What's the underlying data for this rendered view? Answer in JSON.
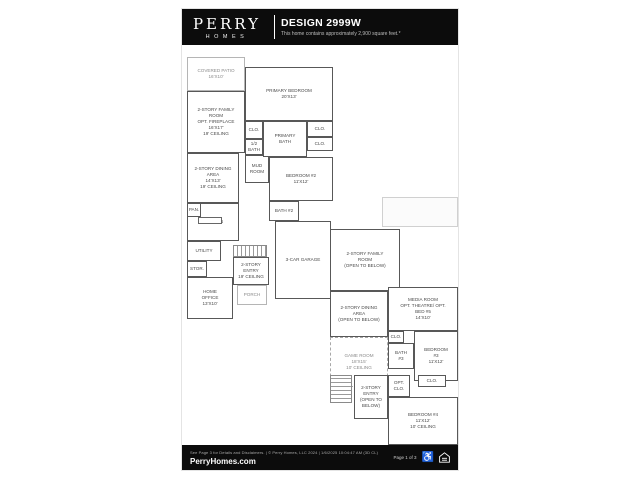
{
  "header": {
    "brand": {
      "name": "PERRY",
      "sub": "HOMES"
    },
    "title": "DESIGN 2999W",
    "subtitle": "This home contains approximately 2,900 square feet.*"
  },
  "footer": {
    "disclaimer": "See Page 3 for Details and Disclaimers.  |  © Perry Homes, LLC 2024  |  1/6/2025 10:04:47 AM  (3D CL)",
    "website": "PerryHomes.com",
    "page_info": "Page 1 of 3",
    "icons": [
      "accessibility-icon",
      "equal-housing-icon"
    ]
  },
  "floorplan": {
    "first_floor": {
      "rooms": [
        {
          "id": "covered-patio",
          "label": "COVERED PATIO\n16'x10'",
          "style": "open",
          "box": [
            5,
            12,
            58,
            34
          ]
        },
        {
          "id": "family-room",
          "label": "2-STORY FAMILY\nROOM\nOPT. FIREPLACE\n16'x17'\n19' Ceiling",
          "style": "solid",
          "box": [
            5,
            46,
            58,
            62
          ]
        },
        {
          "id": "dining-area",
          "label": "2-STORY DINING\nAREA\n14'x13'\n19' Ceiling",
          "style": "solid",
          "box": [
            5,
            108,
            52,
            50
          ]
        },
        {
          "id": "kitchen",
          "label": "KITCHEN",
          "style": "solid",
          "box": [
            5,
            158,
            52,
            38
          ]
        },
        {
          "id": "pantry",
          "label": "PAN.",
          "style": "solid",
          "box": [
            5,
            158,
            14,
            14
          ]
        },
        {
          "id": "utility",
          "label": "UTILITY",
          "style": "solid",
          "box": [
            5,
            196,
            34,
            20
          ]
        },
        {
          "id": "storage-1",
          "label": "STOR.",
          "style": "solid",
          "box": [
            5,
            216,
            20,
            16
          ]
        },
        {
          "id": "home-office",
          "label": "HOME\nOFFICE\n13'x10'",
          "style": "solid",
          "box": [
            5,
            232,
            46,
            42
          ]
        },
        {
          "id": "entry-1",
          "label": "2-STORY\nENTRY\n19' Ceiling",
          "style": "solid",
          "box": [
            51,
            212,
            36,
            28
          ]
        },
        {
          "id": "porch",
          "label": "PORCH",
          "style": "open",
          "box": [
            55,
            240,
            30,
            20
          ]
        },
        {
          "id": "primary-bedroom",
          "label": "PRIMARY BEDROOM\n20'x13'",
          "style": "solid",
          "box": [
            63,
            22,
            88,
            54
          ]
        },
        {
          "id": "closet-1",
          "label": "CLO.",
          "style": "solid",
          "box": [
            63,
            76,
            18,
            18
          ]
        },
        {
          "id": "half-bath",
          "label": "1/2\nBATH",
          "style": "solid",
          "box": [
            63,
            94,
            18,
            16
          ]
        },
        {
          "id": "mud-room",
          "label": "MUD\nROOM",
          "style": "solid",
          "box": [
            63,
            110,
            24,
            28
          ]
        },
        {
          "id": "primary-bath",
          "label": "PRIMARY\nBATH",
          "style": "solid",
          "box": [
            81,
            76,
            44,
            36
          ]
        },
        {
          "id": "closet-2",
          "label": "CLO.",
          "style": "solid",
          "box": [
            125,
            76,
            26,
            16
          ]
        },
        {
          "id": "closet-3",
          "label": "CLO.",
          "style": "solid",
          "box": [
            125,
            92,
            26,
            14
          ]
        },
        {
          "id": "bedroom-2",
          "label": "BEDROOM #2\n11'x12'",
          "style": "solid",
          "box": [
            87,
            112,
            64,
            44
          ]
        },
        {
          "id": "bath-2",
          "label": "BATH #2",
          "style": "solid",
          "box": [
            87,
            156,
            30,
            20
          ]
        },
        {
          "id": "garage",
          "label": "3-CAR GARAGE",
          "style": "solid",
          "box": [
            93,
            176,
            56,
            78
          ]
        }
      ],
      "features": [
        {
          "id": "stairs-first-floor",
          "type": "stairs-h",
          "box": [
            51,
            200,
            34,
            12
          ]
        },
        {
          "id": "kitchen-island",
          "type": "island",
          "box": [
            16,
            172,
            24,
            7
          ]
        }
      ]
    },
    "second_floor": {
      "rooms": [
        {
          "id": "roof-area",
          "label": "",
          "style": "roof",
          "box": [
            200,
            152,
            76,
            30
          ]
        },
        {
          "id": "family-room-open",
          "label": "2-STORY FAMILY\nROOM\n(OPEN TO BELOW)",
          "style": "solid",
          "box": [
            148,
            184,
            70,
            62
          ]
        },
        {
          "id": "dining-area-open",
          "label": "2-STORY DINING\nAREA\n(OPEN TO BELOW)",
          "style": "solid",
          "box": [
            148,
            246,
            58,
            46
          ]
        },
        {
          "id": "media-room",
          "label": "MEDIA ROOM\nOPT. THEATRE/ OPT.\nBED #5\n14'x10'",
          "style": "solid",
          "box": [
            206,
            242,
            70,
            44
          ]
        },
        {
          "id": "game-room",
          "label": "GAME ROOM\n18'x15'\n10' Ceiling",
          "style": "dashed",
          "box": [
            148,
            292,
            58,
            50
          ]
        },
        {
          "id": "closet-4",
          "label": "CLO.",
          "style": "solid",
          "box": [
            206,
            286,
            16,
            12
          ]
        },
        {
          "id": "bath-3",
          "label": "BATH\n#3",
          "style": "solid",
          "box": [
            206,
            298,
            26,
            26
          ]
        },
        {
          "id": "bedroom-3",
          "label": "BEDROOM\n#3\n11'x12'",
          "style": "solid",
          "box": [
            232,
            286,
            44,
            50
          ]
        },
        {
          "id": "entry-open",
          "label": "2-STORY\nENTRY\n(OPEN TO\nBELOW)",
          "style": "solid",
          "box": [
            172,
            330,
            34,
            44
          ]
        },
        {
          "id": "opt-closet",
          "label": "OPT.\nCLO.",
          "style": "solid",
          "box": [
            206,
            330,
            22,
            22
          ]
        },
        {
          "id": "closet-5",
          "label": "CLO.",
          "style": "solid",
          "box": [
            236,
            330,
            28,
            12
          ]
        },
        {
          "id": "bedroom-4",
          "label": "BEDROOM #4\n11'x12'\n10' Ceiling",
          "style": "solid",
          "box": [
            206,
            352,
            70,
            48
          ]
        }
      ],
      "features": [
        {
          "id": "stairs-second-floor",
          "type": "stairs-v",
          "box": [
            148,
            330,
            22,
            28
          ]
        }
      ]
    }
  }
}
